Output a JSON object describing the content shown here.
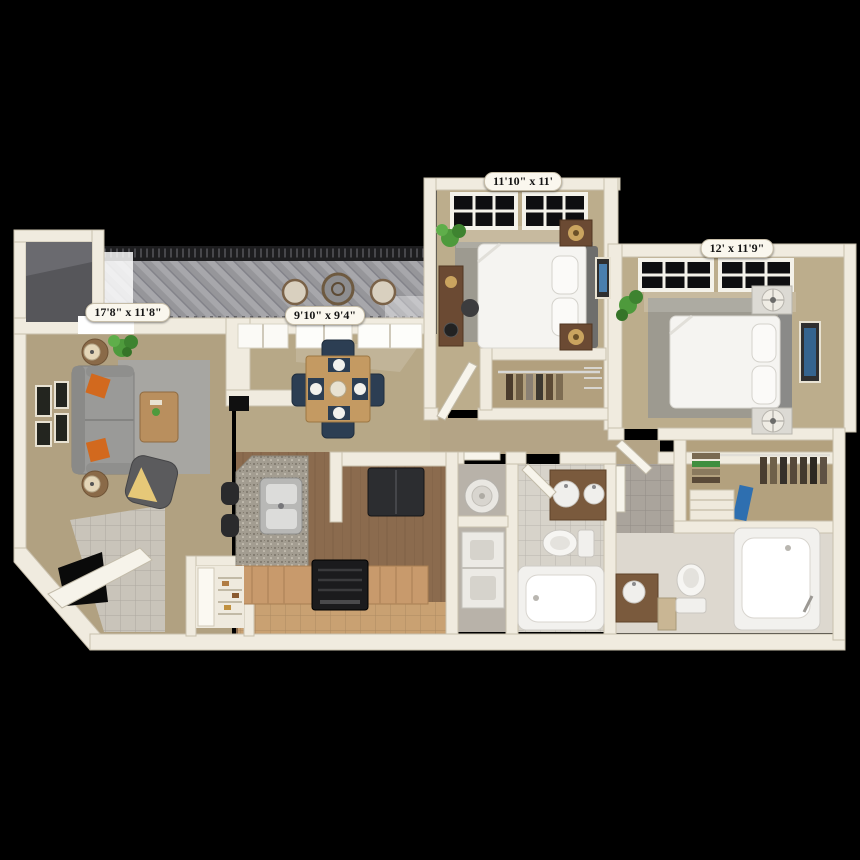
{
  "plan": {
    "rooms": [
      {
        "id": "bedroom-1",
        "dimensions": "11'10\" x 11'"
      },
      {
        "id": "bedroom-2",
        "dimensions": "12' x 11'9\""
      },
      {
        "id": "living-room",
        "dimensions": "17'8\" x 11'8\""
      },
      {
        "id": "dining-room",
        "dimensions": "9'10\" x 9'4\""
      }
    ],
    "colors": {
      "background": "#000000",
      "wall": "#f0ebdf",
      "living_carpet": "#b1a181",
      "dining_carpet": "#b7a887",
      "bedroom_carpet": "#bcad8c",
      "area_rug_gray": "#9d9a90",
      "balcony_deck": "#97979a",
      "kitchen_wood": "#8b6b4e",
      "kitchen_tile": "#c89a6c",
      "counter_granite": "#a39d91",
      "bath_tile": "#aaa49c",
      "accent_pillow_orange": "#d2691e",
      "dining_chair_navy": "#2c3e53",
      "plant_green": "#4e9a3c",
      "label_background": "#faf7ee",
      "label_text": "#151515"
    },
    "furniture_icons": [
      "sofa",
      "orange-throw-pillows",
      "coffee-table",
      "armchair",
      "end-table-lamps",
      "wall-art-frames",
      "tv",
      "houseplant",
      "dining-table",
      "dining-chairs",
      "patio-bistro-set",
      "balcony-railing",
      "kitchen-double-sink",
      "range-stove",
      "refrigerator",
      "pantry-shelves",
      "bar-stools",
      "stacked-washer-dryer",
      "water-heater",
      "bathroom-vanity",
      "toilet",
      "bathtub",
      "walk-in-closet-clothes",
      "bed",
      "nightstand-lamps",
      "desk",
      "area-rug",
      "entry-door",
      "windows"
    ]
  }
}
